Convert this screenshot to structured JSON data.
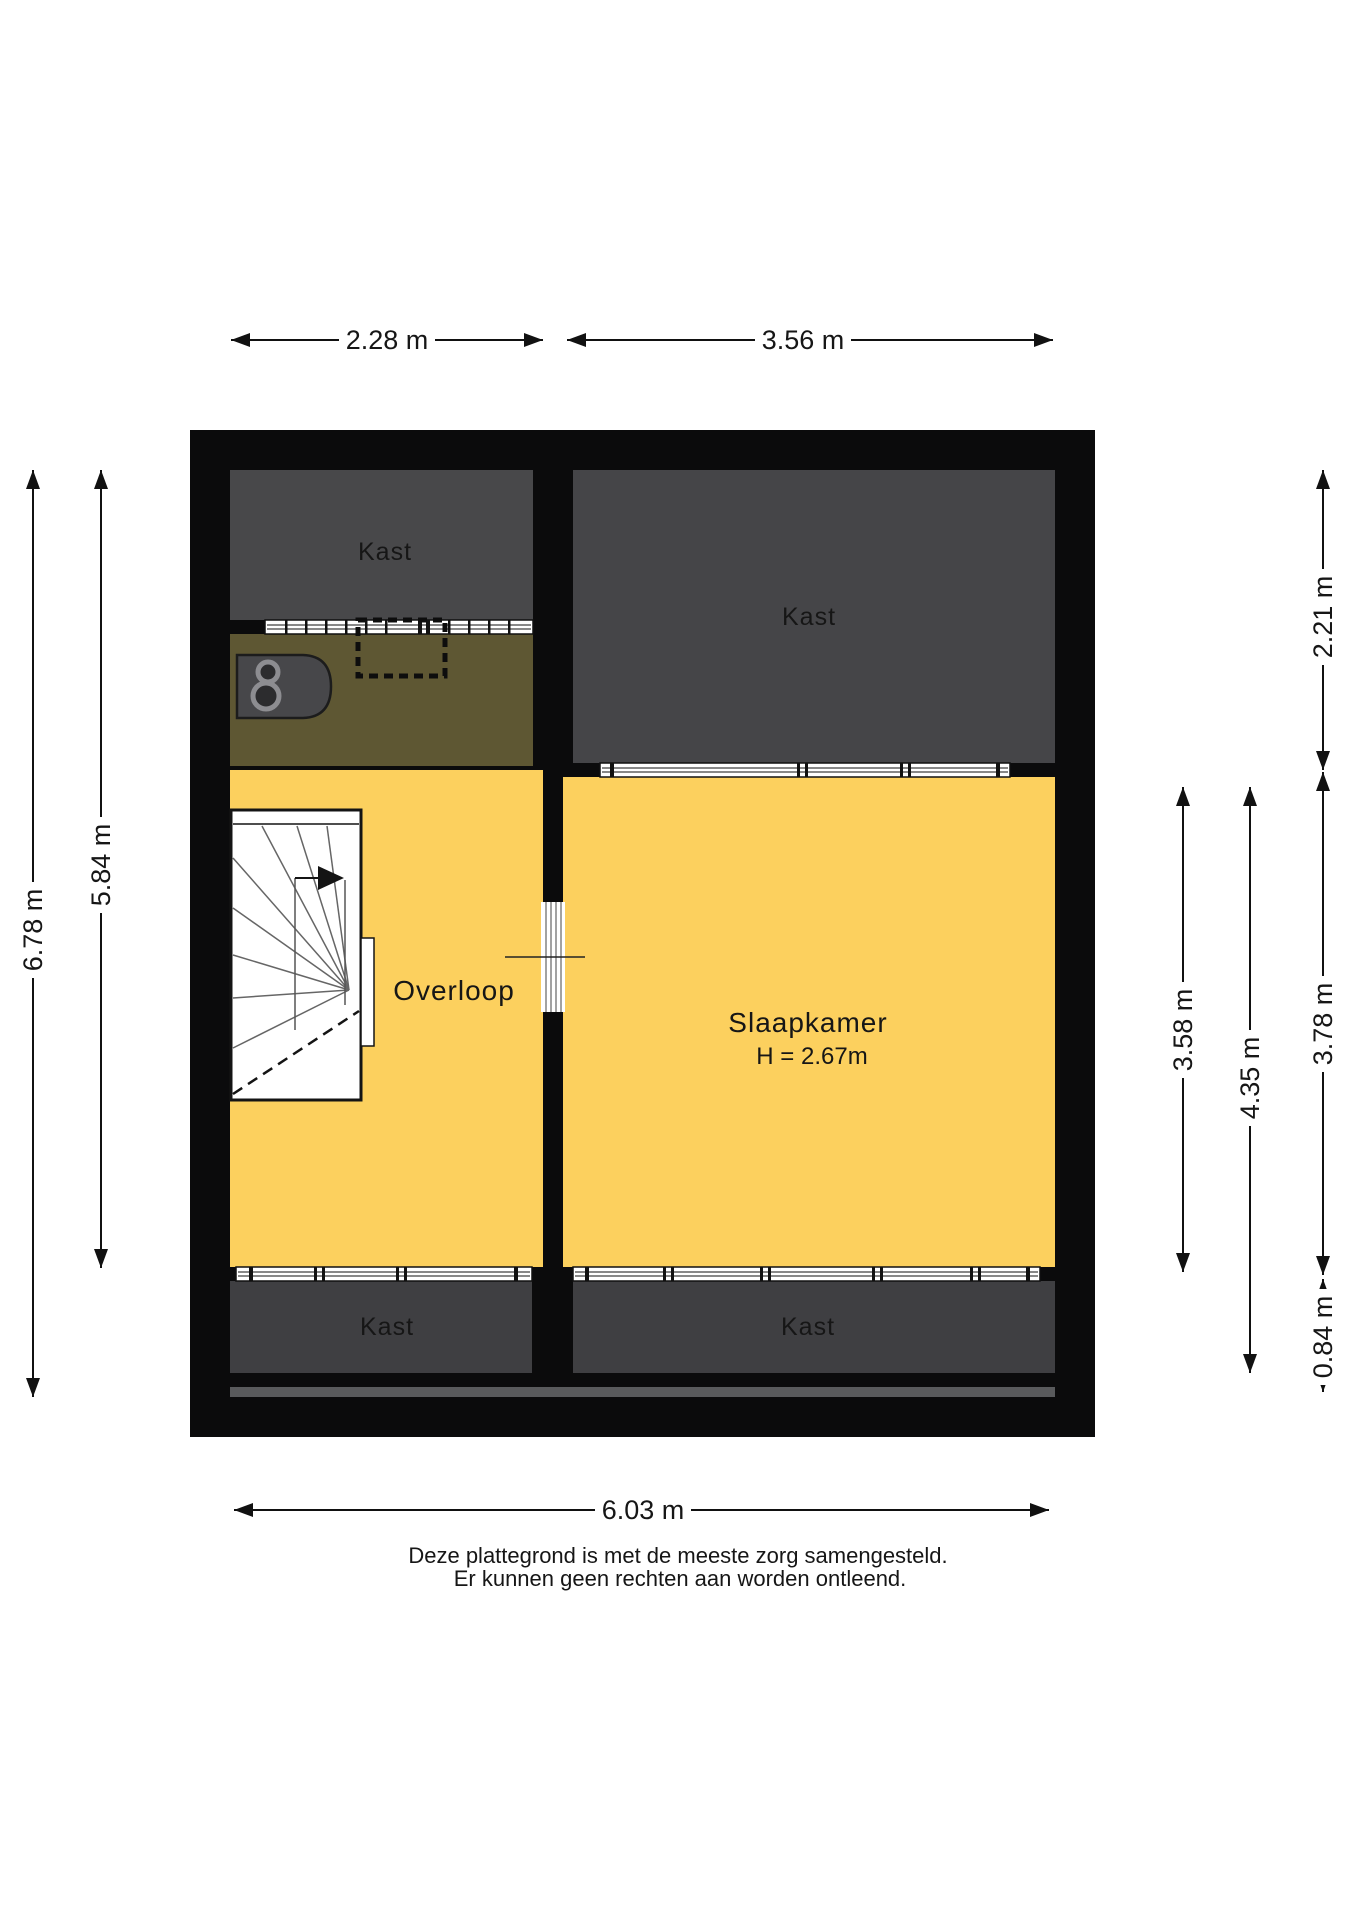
{
  "rooms": {
    "kast_top_left": "Kast",
    "kast_top_right": "Kast",
    "overloop": "Overloop",
    "slaapkamer": "Slaapkamer",
    "slaapkamer_height": "H = 2.67m",
    "kast_bottom_left": "Kast",
    "kast_bottom_right": "Kast"
  },
  "dimensions": {
    "top_left_width": "2.28 m",
    "top_right_width": "3.56 m",
    "left_outer_height": "6.78 m",
    "left_inner_height": "5.84 m",
    "right_kast_depth": "2.21 m",
    "right_inner_height": "3.58 m",
    "right_outer_height": "4.35 m",
    "right_room_depth": "3.78 m",
    "right_kast_bottom_depth": "0.84 m",
    "bottom_width": "6.03 m"
  },
  "disclaimer": {
    "line1": "Deze plattegrond is met de meeste zorg samengesteld.",
    "line2": "Er kunnen geen rechten aan worden ontleend."
  },
  "colors": {
    "wall": "#0b0b0c",
    "kast-top-left": "#48484a",
    "kast-top-right": "#454548",
    "kast-bottom": "#3f3f42",
    "brown": "#5e5733",
    "yellow": "#fcd05e",
    "strip": "#595a5c",
    "paper": "#ffffff",
    "ink": "#161616"
  }
}
